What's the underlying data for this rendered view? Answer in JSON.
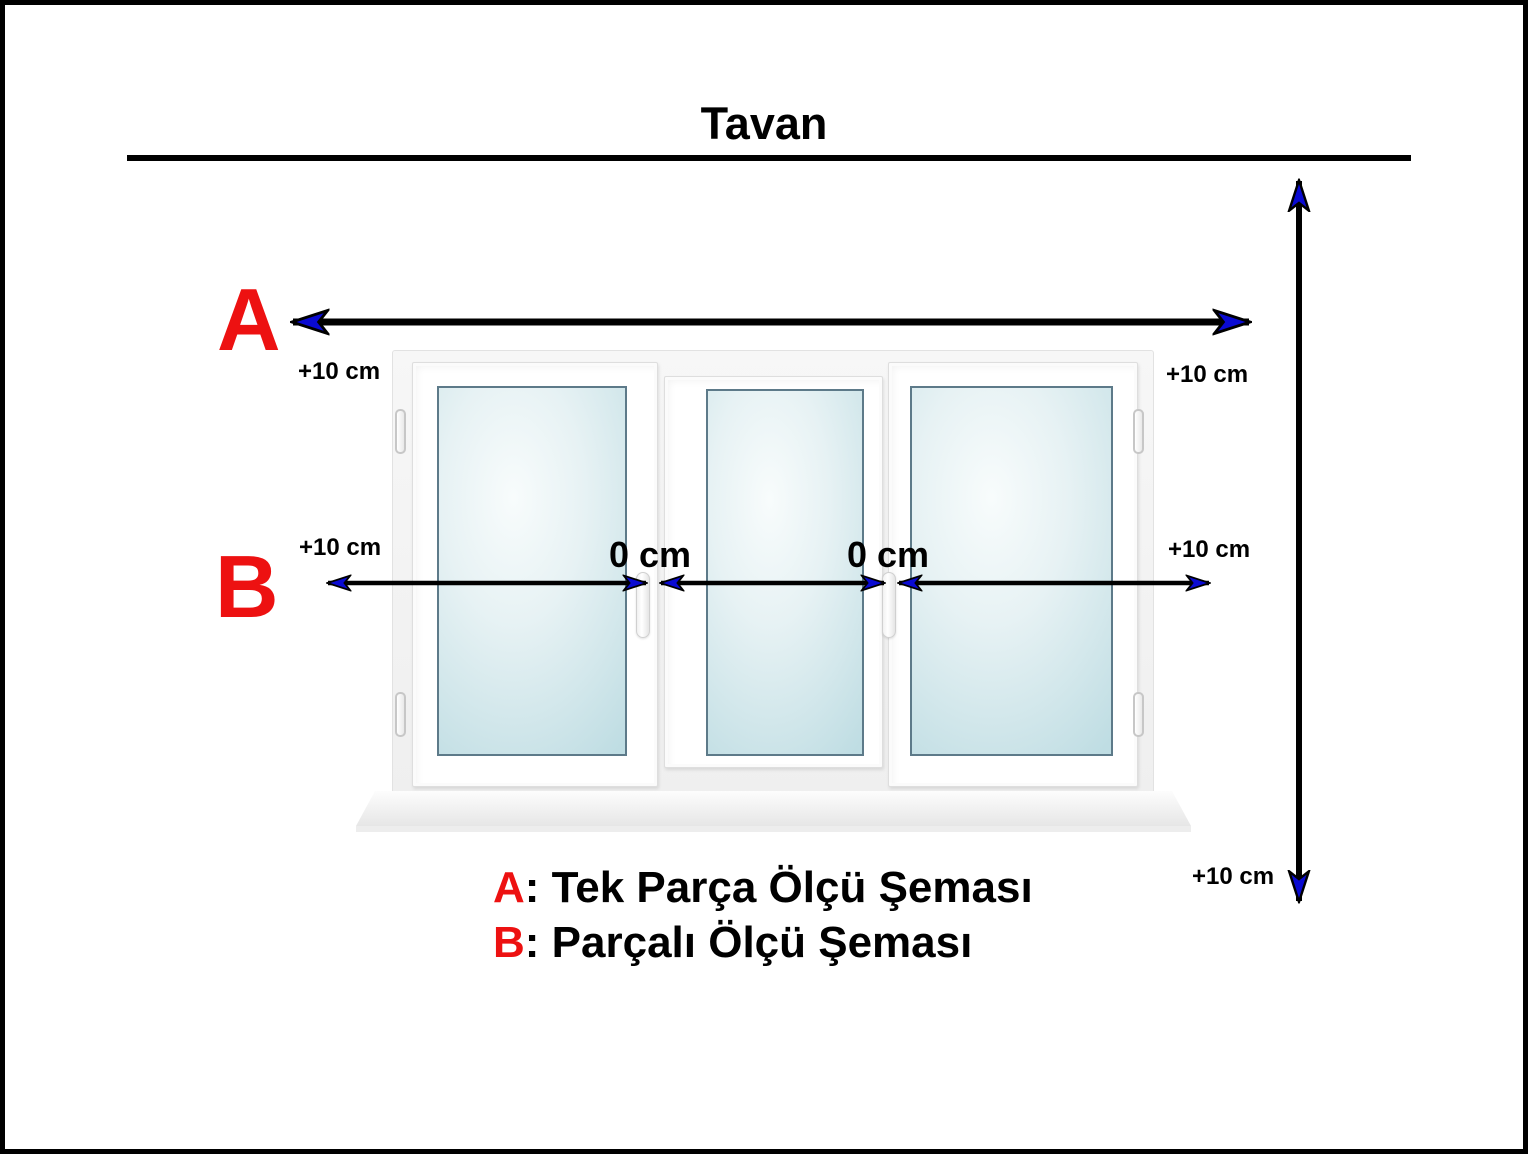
{
  "title": "Tavan",
  "colors": {
    "accent_red": "#ed1111",
    "arrowhead_blue": "#0a0ad2",
    "line_black": "#000000",
    "glass_blue": "#cfe5ea"
  },
  "measure_a": {
    "label": "A",
    "left_offset": "+10 cm",
    "right_offset": "+10 cm"
  },
  "measure_b": {
    "label": "B",
    "left_offset": "+10 cm",
    "right_offset": "+10 cm",
    "gap_left": "0 cm",
    "gap_right": "0 cm"
  },
  "measure_height": {
    "bottom_offset": "+10 cm"
  },
  "legend": {
    "a_label": "A",
    "a_text": ": Tek Parça Ölçü Şeması",
    "b_label": "B",
    "b_text": ": Parçalı Ölçü Şeması"
  }
}
